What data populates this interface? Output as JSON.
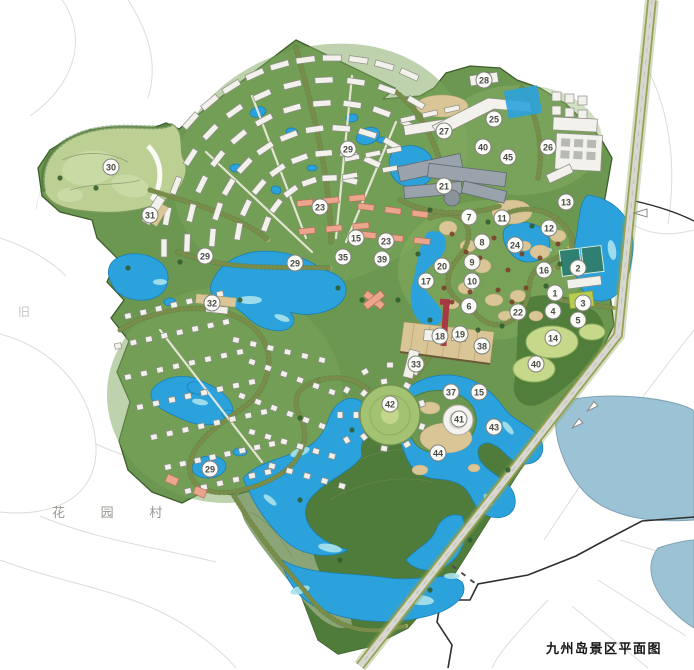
{
  "title": "九州岛景区平面图",
  "labels": {
    "village": "花 园 村",
    "left_partial": "旧"
  },
  "colors": {
    "water": "#2BA2DB",
    "water_light": "#A9E2EC",
    "water_outside": "#9CC3D5",
    "green_mid": "#6B9751",
    "green_dark": "#4F7C3A",
    "golf": "#BCD094",
    "sand": "#D9C596",
    "road": "#B2AC60",
    "building": "#F2F1EC",
    "building_salmon": "#EBA58D",
    "hotel_gray": "#9AA3AC",
    "marker_bg": "#FBFBF8",
    "marker_text": "#4A4A47",
    "boundary_black": "#2E2E2E",
    "red_tower": "#A83844"
  },
  "markers": [
    {
      "n": "30",
      "x": 111,
      "y": 167
    },
    {
      "n": "31",
      "x": 150,
      "y": 215
    },
    {
      "n": "29",
      "x": 348,
      "y": 149
    },
    {
      "n": "28",
      "x": 484,
      "y": 80
    },
    {
      "n": "25",
      "x": 494,
      "y": 119
    },
    {
      "n": "27",
      "x": 444,
      "y": 131
    },
    {
      "n": "40",
      "x": 483,
      "y": 147
    },
    {
      "n": "45",
      "x": 508,
      "y": 157
    },
    {
      "n": "26",
      "x": 548,
      "y": 147
    },
    {
      "n": "21",
      "x": 444,
      "y": 186
    },
    {
      "n": "13",
      "x": 566,
      "y": 202
    },
    {
      "n": "7",
      "x": 469,
      "y": 217
    },
    {
      "n": "11",
      "x": 502,
      "y": 218
    },
    {
      "n": "12",
      "x": 549,
      "y": 228
    },
    {
      "n": "23",
      "x": 320,
      "y": 207
    },
    {
      "n": "15",
      "x": 356,
      "y": 238
    },
    {
      "n": "23",
      "x": 386,
      "y": 241
    },
    {
      "n": "8",
      "x": 482,
      "y": 242
    },
    {
      "n": "24",
      "x": 515,
      "y": 245
    },
    {
      "n": "35",
      "x": 343,
      "y": 257
    },
    {
      "n": "39",
      "x": 382,
      "y": 259
    },
    {
      "n": "29",
      "x": 295,
      "y": 263
    },
    {
      "n": "9",
      "x": 472,
      "y": 262
    },
    {
      "n": "20",
      "x": 442,
      "y": 266
    },
    {
      "n": "16",
      "x": 544,
      "y": 270
    },
    {
      "n": "2",
      "x": 578,
      "y": 268
    },
    {
      "n": "17",
      "x": 426,
      "y": 281
    },
    {
      "n": "10",
      "x": 472,
      "y": 281
    },
    {
      "n": "29",
      "x": 205,
      "y": 256
    },
    {
      "n": "32",
      "x": 212,
      "y": 303
    },
    {
      "n": "1",
      "x": 555,
      "y": 293
    },
    {
      "n": "3",
      "x": 583,
      "y": 303
    },
    {
      "n": "6",
      "x": 469,
      "y": 306
    },
    {
      "n": "22",
      "x": 518,
      "y": 312
    },
    {
      "n": "4",
      "x": 553,
      "y": 311
    },
    {
      "n": "5",
      "x": 578,
      "y": 320
    },
    {
      "n": "18",
      "x": 440,
      "y": 336
    },
    {
      "n": "19",
      "x": 460,
      "y": 334
    },
    {
      "n": "38",
      "x": 482,
      "y": 346
    },
    {
      "n": "14",
      "x": 553,
      "y": 338
    },
    {
      "n": "40",
      "x": 536,
      "y": 364
    },
    {
      "n": "33",
      "x": 416,
      "y": 364
    },
    {
      "n": "37",
      "x": 451,
      "y": 392
    },
    {
      "n": "15",
      "x": 479,
      "y": 392
    },
    {
      "n": "42",
      "x": 390,
      "y": 404
    },
    {
      "n": "41",
      "x": 459,
      "y": 419
    },
    {
      "n": "43",
      "x": 494,
      "y": 427
    },
    {
      "n": "44",
      "x": 438,
      "y": 453
    },
    {
      "n": "29",
      "x": 210,
      "y": 469
    }
  ]
}
